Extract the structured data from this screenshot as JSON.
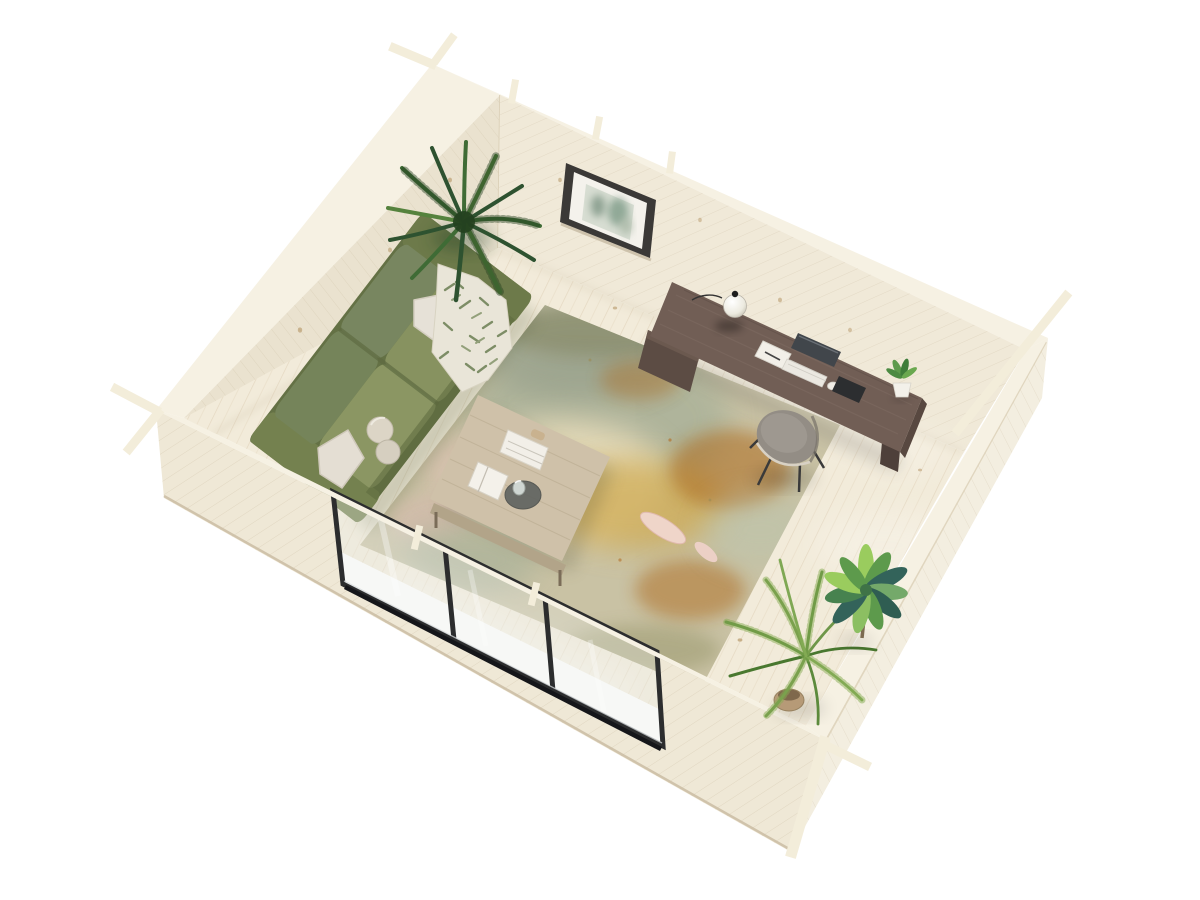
{
  "meta": {
    "canvas": {
      "width": 1200,
      "height": 900
    },
    "view": "aerial-isometric-3d-render",
    "subject": "log-cabin-garden-office-interior"
  },
  "scene": {
    "objects": [
      {
        "name": "log-walls",
        "description_color": "#ece4d2"
      },
      {
        "name": "wood-floor",
        "description_color": "#f2ebda"
      },
      {
        "name": "area-rug",
        "description_color": "#c9c2a4"
      },
      {
        "name": "green-sofa",
        "description_color": "#75845a"
      },
      {
        "name": "throw-pillows",
        "description_color": "#e4ded3"
      },
      {
        "name": "leaf-throw-blanket",
        "description_color": "#e9e5d8"
      },
      {
        "name": "ball-cushions",
        "description_color": "#dcd5c6"
      },
      {
        "name": "coffee-table",
        "description_color": "#cfc1a9"
      },
      {
        "name": "magazines-and-open-book",
        "description_color": "#f2efe8"
      },
      {
        "name": "decor-tray",
        "description_color": "#5f625f"
      },
      {
        "name": "writing-desk",
        "description_color": "#715e55"
      },
      {
        "name": "globe-desk-lamp",
        "description_color": "#f1efe7"
      },
      {
        "name": "monitor",
        "description_color": "#41464b"
      },
      {
        "name": "keyboard",
        "description_color": "#ebe8e1"
      },
      {
        "name": "tablet",
        "description_color": "#2c2e30"
      },
      {
        "name": "desk-plant",
        "description_color": "#5d9a4c"
      },
      {
        "name": "desk-chair",
        "description_color": "#938d85"
      },
      {
        "name": "wall-art-frame",
        "description_color": "#3b3937"
      },
      {
        "name": "indoor-palm",
        "description_color": "#3f6b35"
      },
      {
        "name": "areca-palm",
        "description_color": "#6f9749"
      },
      {
        "name": "dracaena-plant",
        "description_color": "#33635a"
      },
      {
        "name": "sliding-glass-door",
        "description_color": "#2c2d2e"
      }
    ]
  },
  "colors": {
    "background": "#ffffff",
    "wall_face_bl": "#eae2cf",
    "wall_face_br": "#f0e9d8",
    "wall_band": "#f6f1e3",
    "wall_ext_fl": "#efe8d6",
    "wall_ext_fr": "#f3eee0",
    "wall_grain": "#cdbfa4",
    "wall_seam": "#c4b79d",
    "floor": "#f2ebda",
    "floor_line": "#d8c8ac",
    "knot": "#a9854f",
    "rug_base": "#c9c2a4",
    "rug_sage": "#a9b199",
    "rug_gray": "#9aa28d",
    "rug_cream": "#e7dcba",
    "rug_gold": "#cfa94e",
    "rug_rust": "#ad6a1e",
    "rug_blue": "#b9c4ad",
    "rug_pink": "#dcb9b4",
    "rug_leaf": "#efd5c9",
    "rug_dark": "#6f7045",
    "sofa_base": "#647145",
    "sofa_back": "#75845a",
    "sofa_seat": "#8b9663",
    "sofa_arm": "#74814f",
    "sofa_shadow": "#4a5633",
    "pillow": "#e4ded3",
    "throw": "#e9e5d8",
    "throw_leaf": "#7d8d66",
    "ball": "#dcd5c6",
    "table_top": "#cfc1a9",
    "table_edge": "#b2a489",
    "paper": "#f2efe8",
    "tray": "#5f625f",
    "glass_cup": "#cfd6d2",
    "desk_top": "#715e55",
    "desk_drawer": "#5c4c44",
    "desk_leg": "#4e403a",
    "lamp_globe": "#f1efe7",
    "lamp_dark": "#1d1d1d",
    "monitor": "#41464b",
    "keyboard": "#ebe8e1",
    "tablet": "#2c2e30",
    "chair_seat": "#938d85",
    "chair_piping": "#d8d1c4",
    "chair_leg": "#3a3a3a",
    "palm_dark": "#2e5230",
    "palm_mid": "#3f6b35",
    "palm_light": "#55823d",
    "areca": "#6f9749",
    "leaf_bright": "#9acc5e",
    "leaf_mid": "#5d9a4c",
    "leaf_teal": "#33635a",
    "pot_tan": "#b69a77",
    "pot_white": "#f3f1ea",
    "frame": "#3b3937",
    "mat": "#f4f2ec",
    "art_bg": "#d7ddd2",
    "art_green": "#7f9b88",
    "door_frame": "#2c2d2e",
    "door_glass": "#e7ece4",
    "door_glint": "#d6dadc",
    "stick": "#f3edda"
  }
}
